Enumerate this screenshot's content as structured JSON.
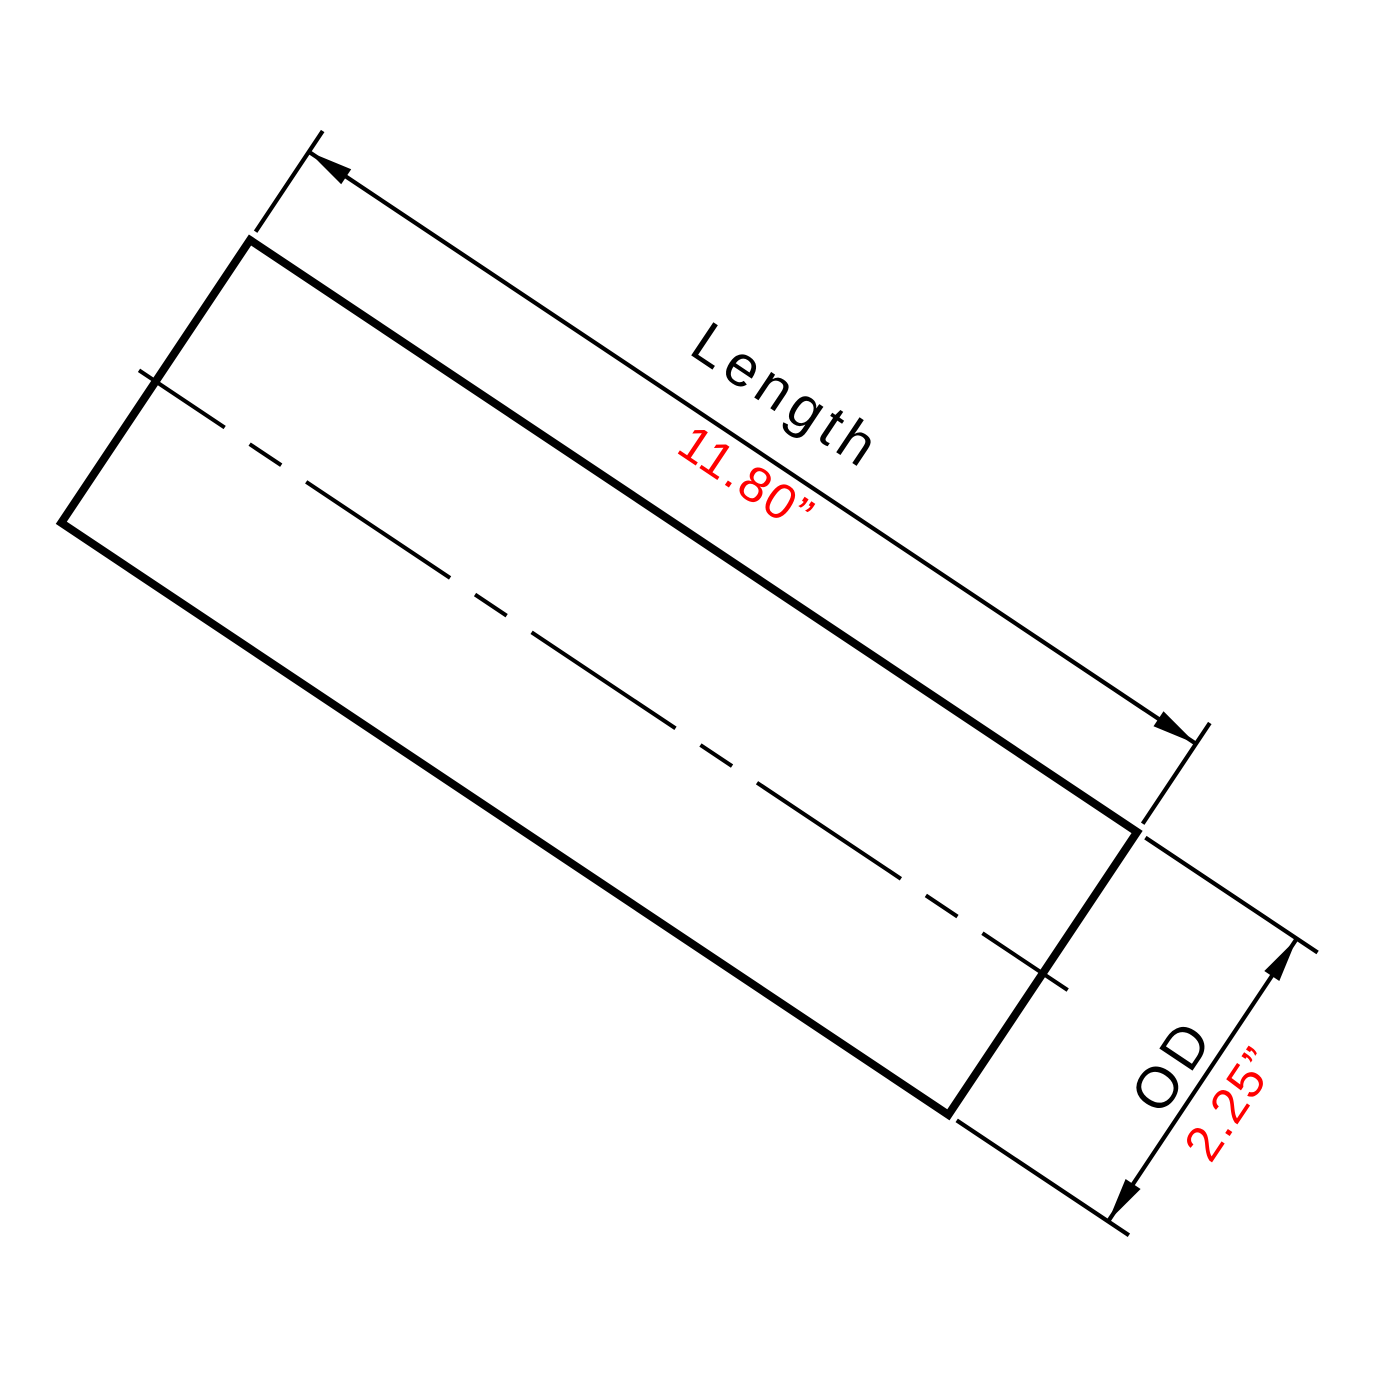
{
  "colors": {
    "ink": "#000000",
    "value_text": "#ff0000",
    "background": "#ffffff"
  },
  "dimensions": {
    "length": {
      "label": "Length",
      "value": "11.80”"
    },
    "outer_diameter": {
      "label": "OD",
      "value": "2.25”"
    }
  }
}
